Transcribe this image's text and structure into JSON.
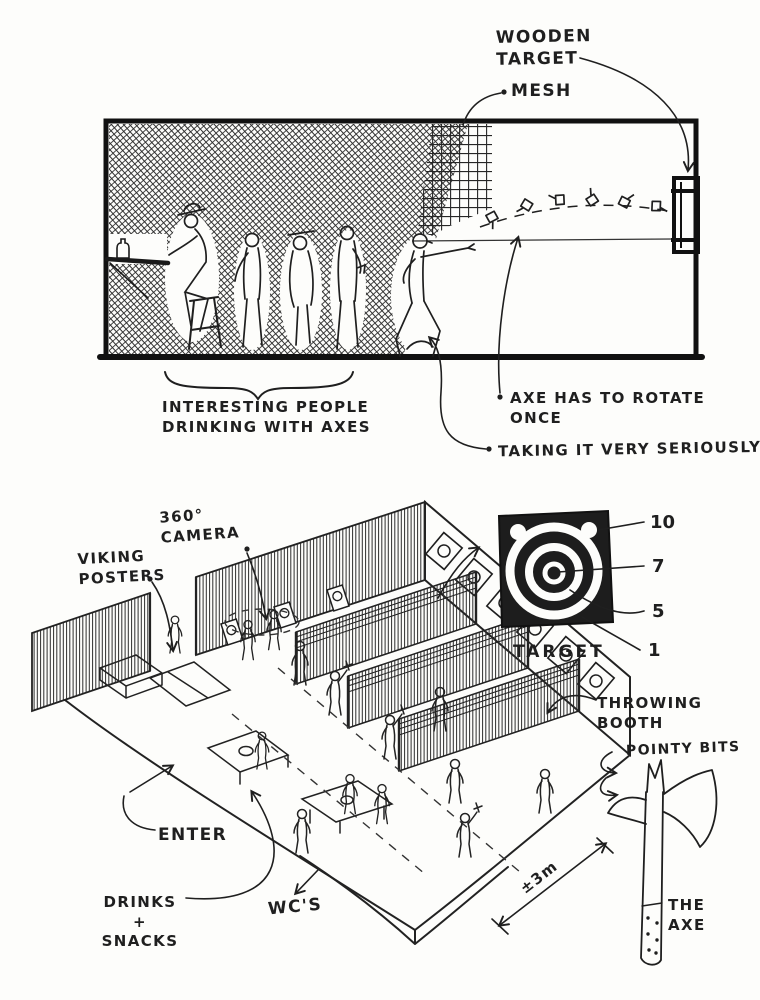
{
  "sheet": {
    "title": "Axe throwing venue concept sketch",
    "paper_color": "#fdfdfb",
    "ink_color": "#1f1f1f"
  },
  "side_view": {
    "name": "side section of throwing range",
    "labels": {
      "wooden_target": [
        "WOODEN",
        "TARGET"
      ],
      "mesh": "MESH",
      "people_caption": [
        "INTERESTING PEOPLE",
        "DRINKING WITH AXES"
      ],
      "rotate_note": [
        "AXE HAS TO ROTATE",
        "ONCE"
      ],
      "serious_note": "TAKING IT VERY SERIOUSLY !"
    }
  },
  "iso_view": {
    "name": "isometric floor plan",
    "labels": {
      "camera": [
        "360°",
        "CAMERA"
      ],
      "posters": [
        "VIKING",
        "POSTERS"
      ],
      "enter": "ENTER",
      "drinks": [
        "DRINKS",
        "+",
        "SNACKS"
      ],
      "wc": "WC'S",
      "dimension": "±3m",
      "booth": [
        "THROWING",
        "BOOTH"
      ]
    }
  },
  "target_detail": {
    "caption": "TARGET",
    "scores": [
      "10",
      "7",
      "5",
      "1"
    ]
  },
  "axe_detail": {
    "pointy": "POINTY BITS",
    "name": [
      "THE",
      "AXE"
    ]
  }
}
